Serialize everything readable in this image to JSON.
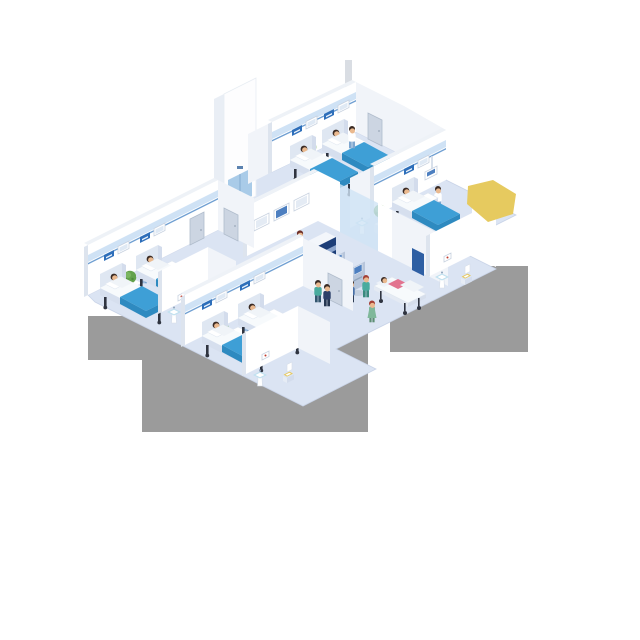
{
  "scene": {
    "type": "isometric hospital ward cutaway illustration",
    "background": "#ffffff",
    "floor_shape": "stepped diamond with gray drop-shadow blocks",
    "highlight": "yellow polygon overlay at upper right"
  },
  "palette": {
    "floor": "#dbe4f3",
    "wall": "#ffffff",
    "wallShade": "#f1f4f9",
    "wallEdge": "#dde4ee",
    "wallTop": "#eef2f7",
    "trimBand": "#cfe2f5",
    "trimLine": "#6f9fd2",
    "panelBlue": "#2e6fba",
    "panelLight": "#eaf2fb",
    "door": "#ccd5e2",
    "doorEdge": "#b0bccc",
    "glass": "#cfe3f5",
    "bedBlue": "#3e9fd6",
    "bedBlueDark": "#2e8ac0",
    "sheet": "#f7fafc",
    "bedFrame": "#d6dfee",
    "bedFrameDark": "#c2cfe3",
    "headboard": "#dfe7f2",
    "leg": "#2f3440",
    "desk": "#1d3e78",
    "deskSide": "#152f5e",
    "deskStripe": "#8ea6cd",
    "deskTop": "#f3f6fb",
    "kiosk": "#b7c5da",
    "kioskSide": "#9aabc5",
    "screen": "#4d7fc0",
    "plant": "#63a24c",
    "plantLight": "#7ab561",
    "plantDark": "#4e8a3c",
    "pot": "#edf1f7",
    "cubeL": "#e6ecf5",
    "cubeR": "#d3dcec",
    "skin": "#eab98f",
    "hair": "#3a2a23",
    "shadow": "#9b9b9b",
    "yellow": "#e6ca5f",
    "elevDoor": "#a9cbe8",
    "sink": "#bfe0ef",
    "seat": "#e7c95f",
    "poster": "#2e5fa3",
    "pink": "#e2738f",
    "gown": "#f0f4f8"
  },
  "reception": {
    "desk_sign": "P≥M",
    "wall_screens": 3,
    "staff": 1
  },
  "rooms": [
    {
      "id": "ward-top",
      "beds": 2,
      "patients": 2,
      "nurses": 1,
      "plants": 1,
      "bedside_tables": 2,
      "wall_panels": 2
    },
    {
      "id": "ward-right",
      "beds": 1,
      "patients": 1,
      "nurses": 1,
      "plants": 1,
      "bedside_tables": 1,
      "overhead_monitor": 1
    },
    {
      "id": "ward-left",
      "beds": 2,
      "patients": 2,
      "nurses": 1,
      "plants": 1,
      "bedside_tables": 2,
      "wall_panels": 2
    },
    {
      "id": "ward-bottom",
      "beds": 2,
      "patients": 2,
      "nurses": 1,
      "plants": 1,
      "bedside_tables": 2,
      "wall_panels": 2
    }
  ],
  "bathrooms": [
    {
      "id": "bathroom-left",
      "sink": 1,
      "toilet": 1,
      "picture": 1
    },
    {
      "id": "bathroom-bottom",
      "sink": 1,
      "toilet": 1,
      "picture": 1
    },
    {
      "id": "bathroom-right",
      "sink": 1,
      "toilet": 1,
      "picture": 1
    }
  ],
  "hall": {
    "elevator": 1,
    "check_in_kiosks": 2,
    "kiosk_users": 2,
    "walking_visitors": 2,
    "stretcher": {
      "patients": 1,
      "nurses": 1
    }
  },
  "people": [
    {
      "id": "top-nurse",
      "role": "nurse",
      "top": "#ffffff",
      "bottom": "#7ea6cf",
      "hair": "#3a2a23"
    },
    {
      "id": "right-nurse",
      "role": "nurse",
      "top": "#ffffff",
      "bottom": "#7ea6cf",
      "hair": "#3a2a23"
    },
    {
      "id": "left-nurse",
      "role": "nurse",
      "top": "#ffffff",
      "bottom": "#7ea6cf",
      "hair": "#3a2a23"
    },
    {
      "id": "bottom-nurse",
      "role": "nurse",
      "top": "#ffffff",
      "bottom": "#7ea6cf",
      "hair": "#3a2a23"
    },
    {
      "id": "elevator-visitor",
      "role": "visitor",
      "top": "#8fb3da",
      "bottom": "#45586e",
      "hair": "#3a2a23"
    },
    {
      "id": "kiosk-user-1",
      "role": "visitor",
      "top": "#d9853c",
      "bottom": "#4a4f5c",
      "hair": "#3a2a23"
    },
    {
      "id": "kiosk-user-2",
      "role": "visitor",
      "top": "#4a71a8",
      "bottom": "#2f3d55",
      "hair": "#3a2a23"
    },
    {
      "id": "visitor-teal",
      "role": "staff",
      "top": "#49ab9e",
      "bottom": "#33566e",
      "hair": "#3a2a23"
    },
    {
      "id": "visitor-suit",
      "role": "visitor",
      "top": "#2c4069",
      "bottom": "#263752",
      "hair": "#3a2a23"
    },
    {
      "id": "nurse-green-dress",
      "role": "nurse",
      "top": "#7fb89a",
      "bottom": "#5e8f75",
      "hair": "#a33f35"
    },
    {
      "id": "stretcher-nurse",
      "role": "nurse",
      "top": "#49ab9e",
      "bottom": "#3a8a7e",
      "hair": "#a33f35"
    }
  ]
}
